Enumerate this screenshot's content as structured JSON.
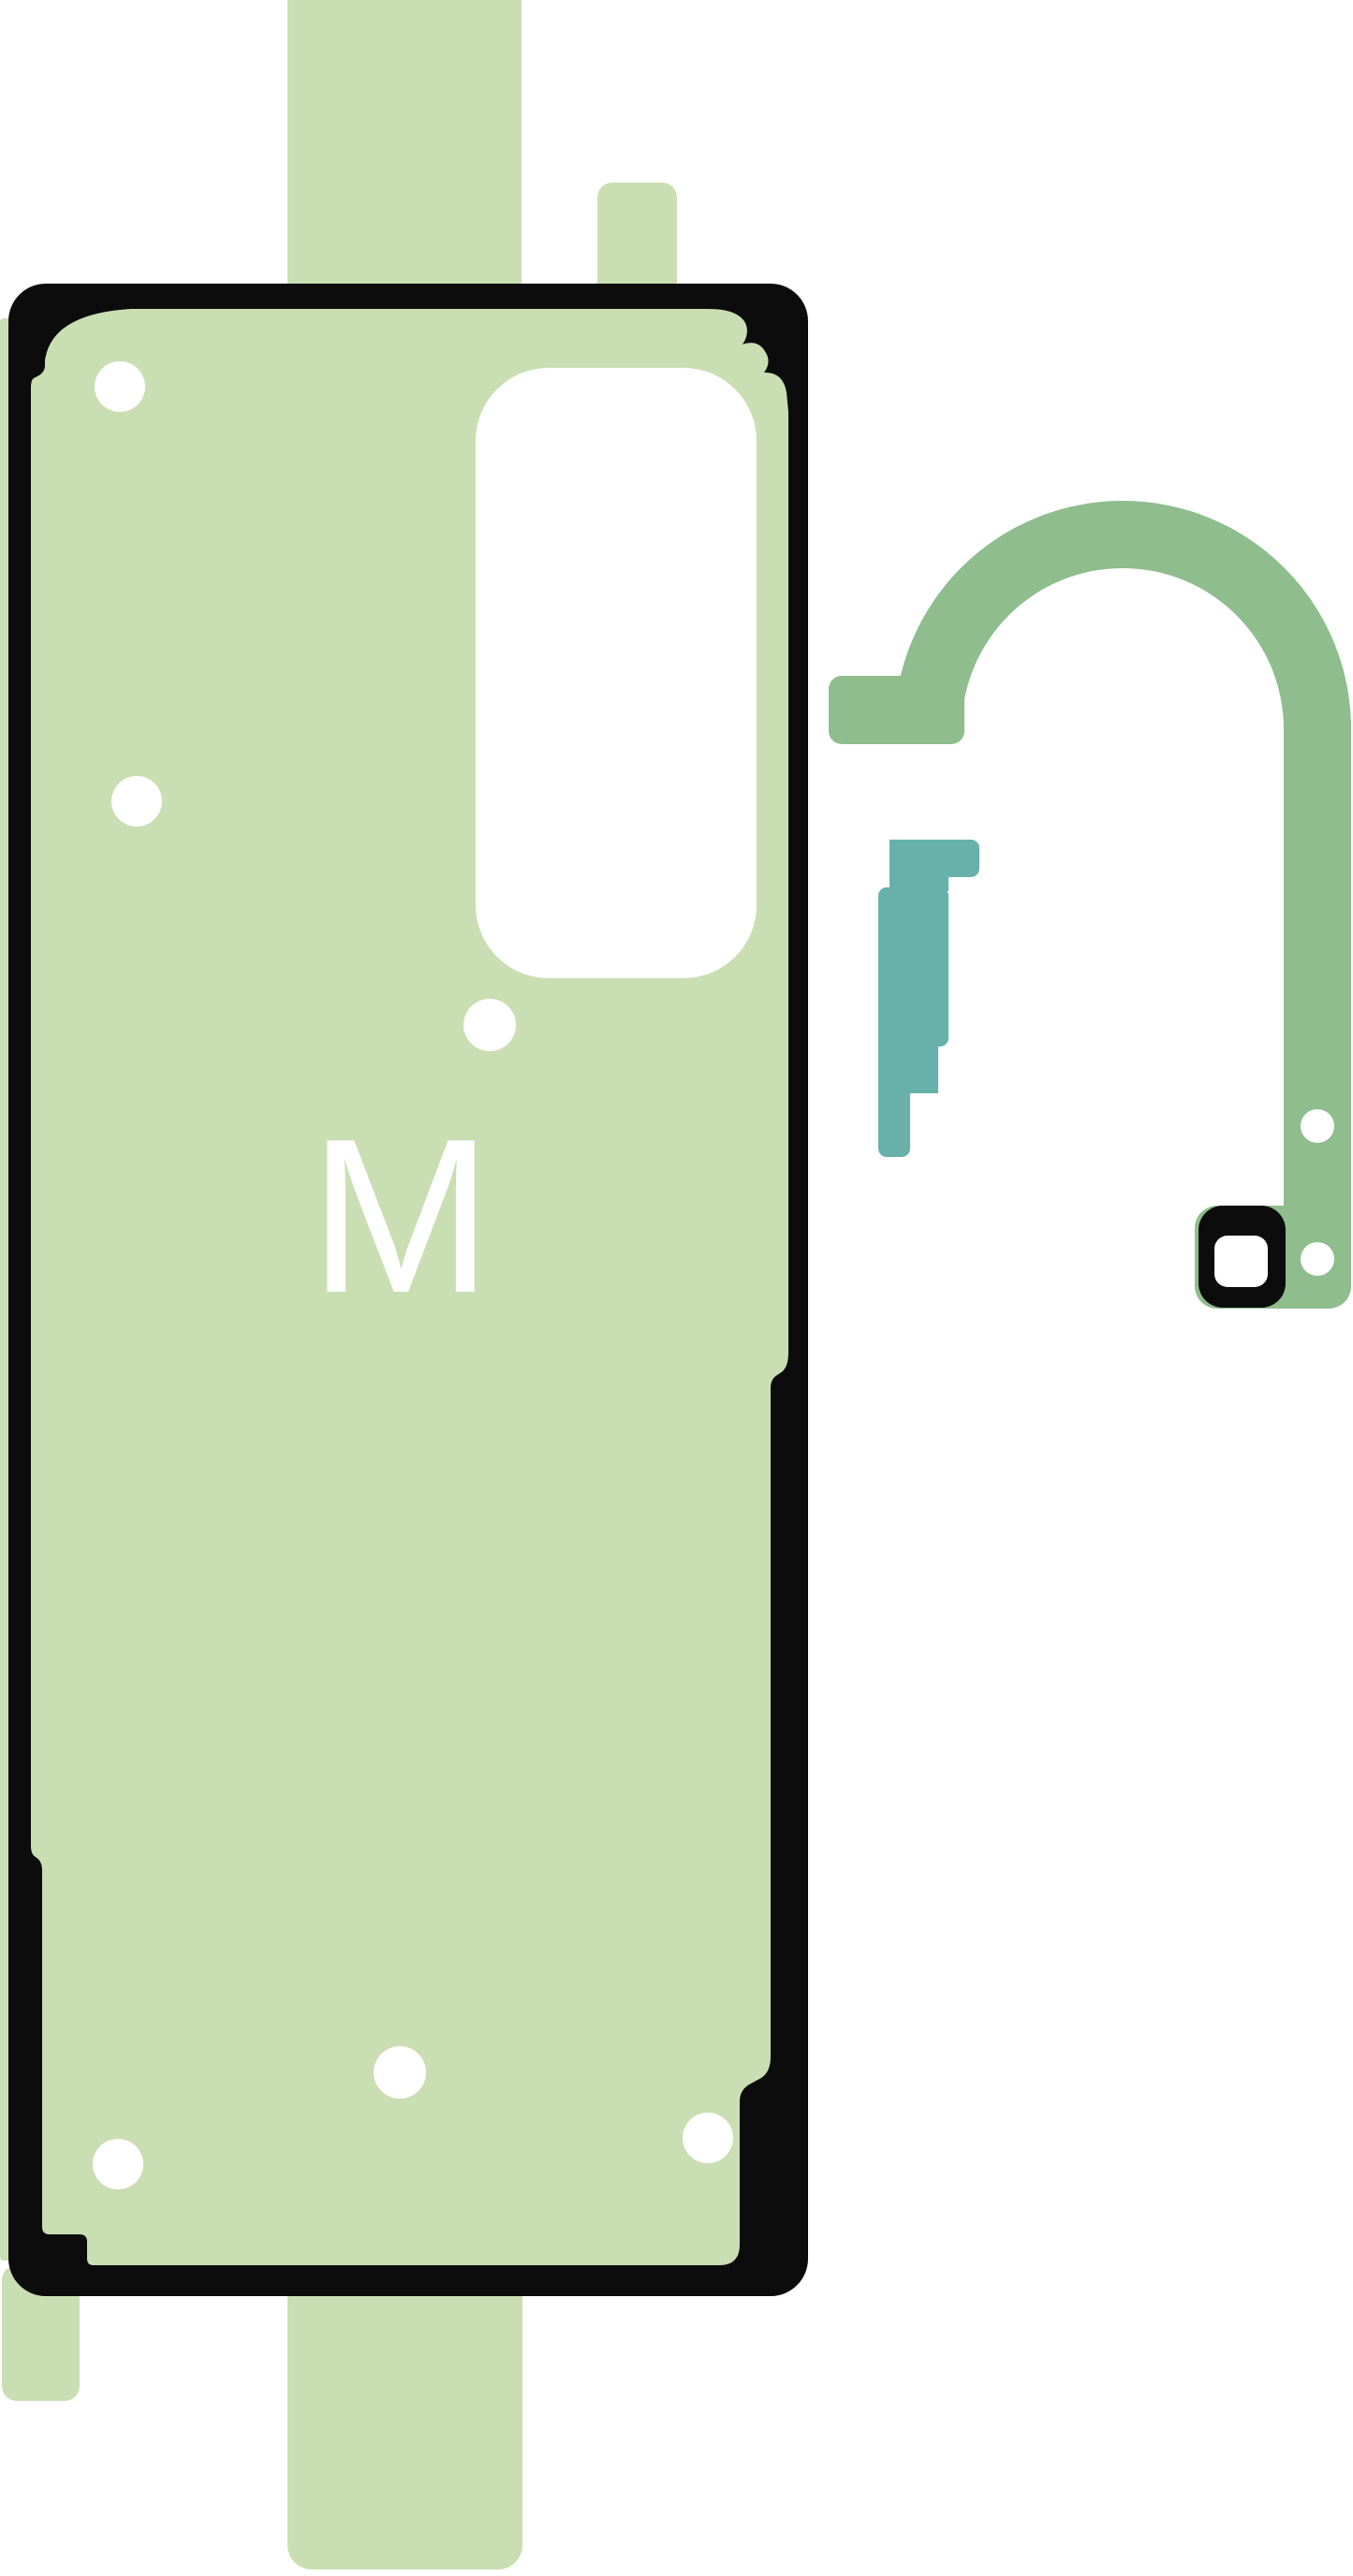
{
  "page": {
    "background_color": "#ffffff"
  },
  "colors": {
    "backing_green": "#c9dfb3",
    "sheet_green": "#c9dfb3",
    "outline_black": "#0c0c0c",
    "hook_green": "#8fbd8e",
    "clip_teal": "#67b1aa",
    "hole_white": "#ffffff"
  },
  "sheet": {
    "label": "M"
  }
}
